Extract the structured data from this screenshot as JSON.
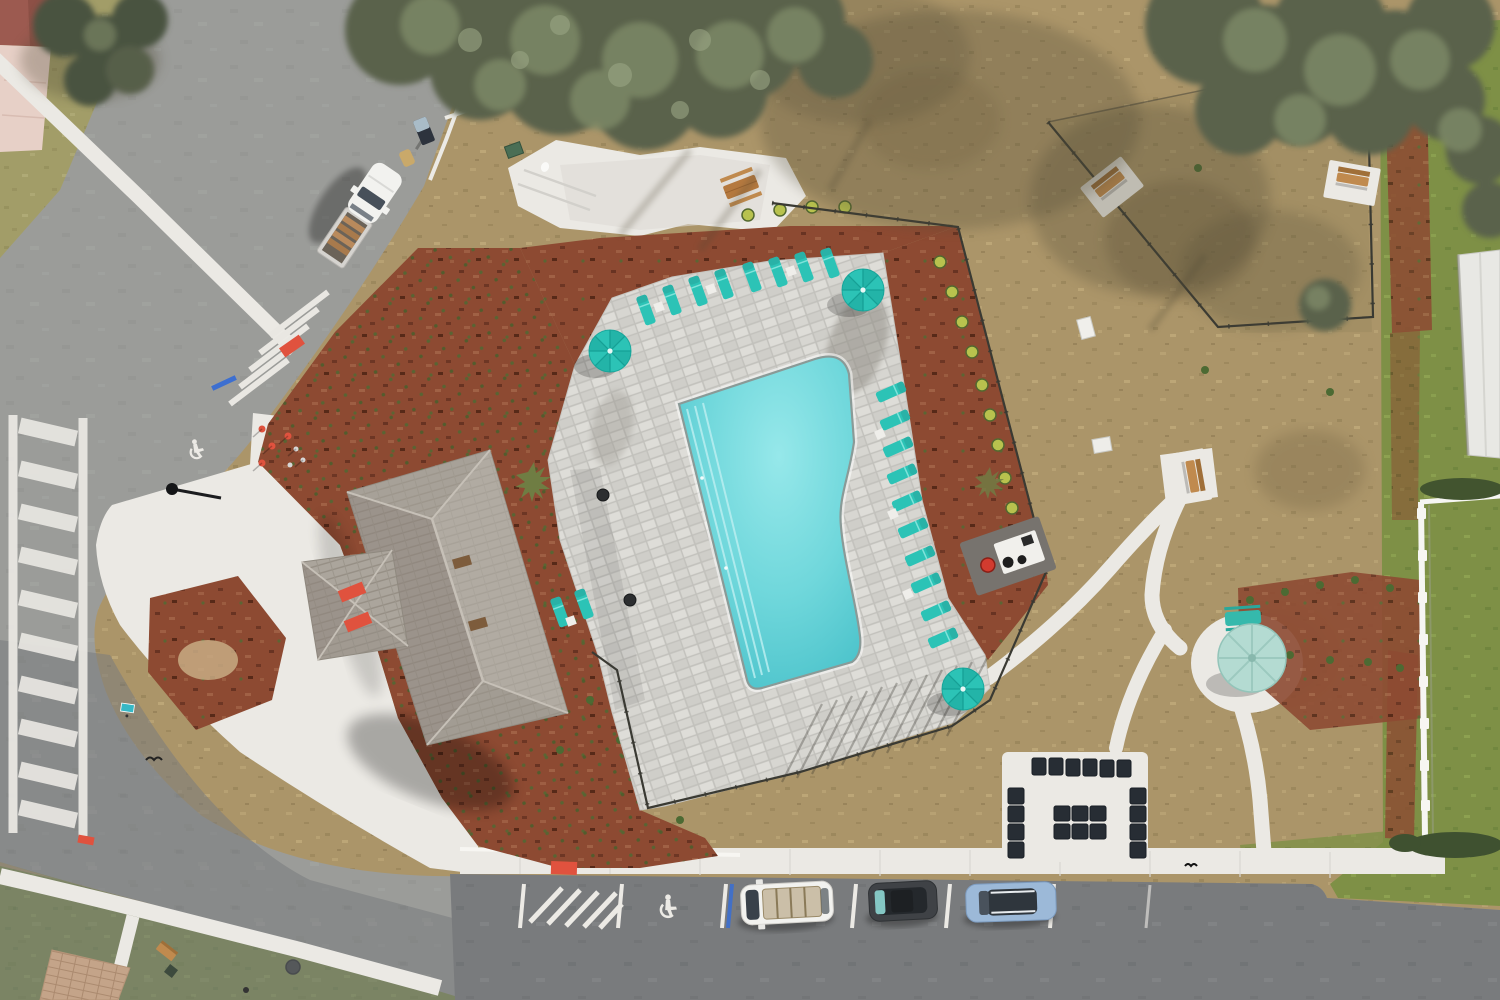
{
  "image": {
    "type": "aerial-drone-photo",
    "subject": "Community pool amenity area with clubhouse, pool deck, dog park, streets and parking",
    "view": "top-down"
  },
  "labels": {
    "scene": "Aerial drone view of a community pool amenity area",
    "ground": "Dry tan grass ground",
    "streets": "Asphalt streets and parking lot",
    "sidewalks": "Concrete sidewalks and walkways",
    "crosswalk": "Ladder-style pedestrian crosswalk",
    "pool": "Free-form swimming pool",
    "pool_deck": "Gray paver pool deck",
    "clubhouse": "Clubhouse with gray shingle hip roof",
    "mulch": "Red mulch landscaping beds",
    "dog_park": "Fenced dog park with benches",
    "parking": "Parking stalls with accessible space",
    "truck": "White pickup truck parked on street",
    "cars": "Three parked cars",
    "teal_umbrellas": "Teal patio umbrellas",
    "mint_umbrella": "Pale green picnic umbrella",
    "loungers": "Teal chaise lounge chairs",
    "benches": "Park benches",
    "grill": "Outdoor grill station",
    "lounge_set": "Dark outdoor lounge furniture on patio",
    "picnic_table": "Wooden picnic table",
    "white_fence": "White vinyl fence",
    "trees": "Tree canopies",
    "house": "Neighboring house roof and driveway",
    "white_roof": "Neighboring white roof at right edge"
  },
  "counts": {
    "teal_umbrellas": 3,
    "mint_umbrellas": 1,
    "lounge_chairs": 20,
    "parked_cars": 3,
    "parked_trucks": 1,
    "benches": 4,
    "picnic_tables": 2,
    "grills": 1,
    "crosswalk_bars": 10
  },
  "palette": {
    "base-grass": "#ab9569",
    "grass-dark": "#937f55",
    "grass-light": "#c3ae7e",
    "green-grass": "#7e9046",
    "green-dark": "#69803a",
    "lawn-nw": "#a29d68",
    "asphalt": "#9b9c99",
    "asphalt-dark": "#797b7d",
    "concrete": "#ebe9e4",
    "concrete-bright": "#f7f6f2",
    "paver": "#d7d6d1",
    "paver-joint": "#c2c1bc",
    "pool-light": "#96e8ea",
    "pool-mid": "#5fd0d6",
    "pool-deep": "#3ab5c0",
    "coping": "#8a9a97",
    "mulch": "#8d4a32",
    "mulch-dark": "#5f2d1e",
    "mulch-light": "#a5674a",
    "teal": "#2cc3b6",
    "teal-dark": "#1ba99e",
    "mint": "#b4dbd2",
    "mint-dark": "#93c4b9",
    "roof": "#aba59c",
    "roof-dark": "#90897f",
    "roof-light": "#c6c0b7",
    "wood": "#c08a4e",
    "wood-dark": "#a06f38",
    "tree": "#5a624b",
    "tree-light": "#7e8a68",
    "tree-pale": "#9aa584",
    "fence": "#3a3a33",
    "white-fence": "#f6f6f3",
    "navy": "#272d34",
    "red": "#e0523e",
    "blue": "#3d6fd0",
    "sign-teal": "#36b8c6",
    "car-white": "#f2f2ef",
    "car-dark": "#3f4246",
    "car-blue": "#9cb9d8",
    "maroon-roof": "#9c5a50",
    "pink-drive": "#e7d0c7"
  }
}
